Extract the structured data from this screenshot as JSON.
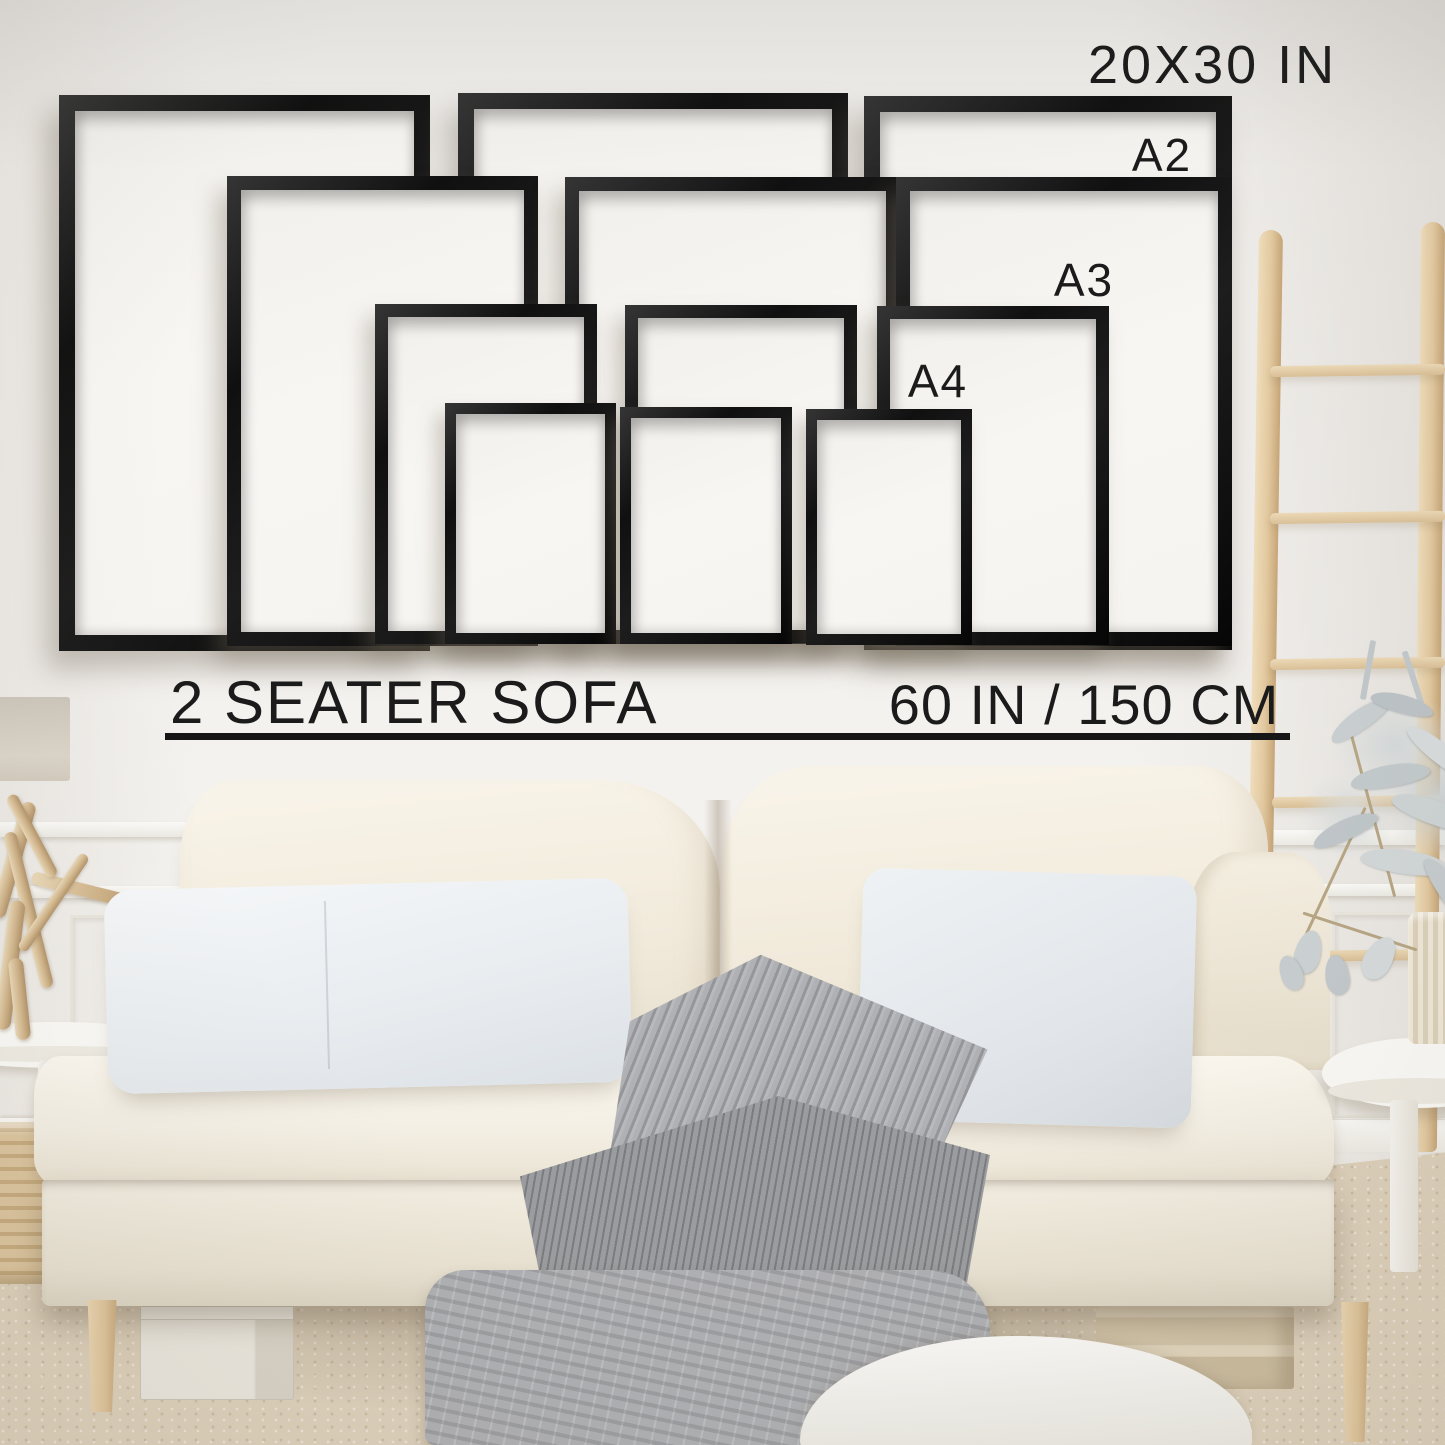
{
  "size_guide": {
    "largest_size_label": "20X30 IN",
    "size_labels": [
      {
        "id": "a2",
        "text": "A2"
      },
      {
        "id": "a3",
        "text": "A3"
      },
      {
        "id": "a4",
        "text": "A4"
      }
    ],
    "sofa_type_label": "2 SEATER SOFA",
    "sofa_width_label": "60 IN / 150 CM",
    "frames": {
      "sizes": [
        "20x30 in",
        "A2",
        "A3",
        "A4"
      ],
      "frames_per_size": 3,
      "total_frames": 12
    }
  },
  "colors": {
    "frame_black": "#141414",
    "annotation_text": "#1b1b1b",
    "wall": "#f3f1ee",
    "frame_mat": "#f7f5f2",
    "sofa_fabric": "#f3eee3",
    "pillow_gray_white": "#eaedf0",
    "blanket_gray": "#a5a6a9",
    "ladder_wood": "#e2c89f",
    "carpet": "#ddd0ba"
  }
}
